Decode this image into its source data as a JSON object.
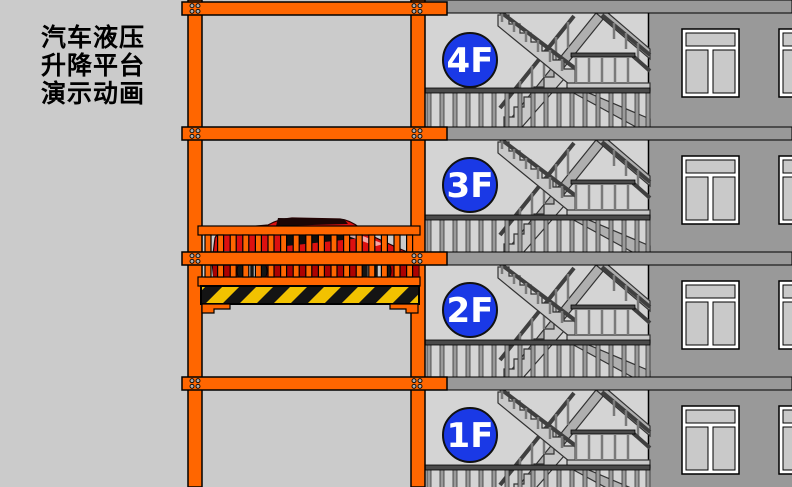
{
  "title": {
    "lines": [
      "汽车液压",
      "升降平台",
      "演示动画"
    ]
  },
  "building": {
    "floors": [
      {
        "label": "4F"
      },
      {
        "label": "3F"
      },
      {
        "label": "2F"
      },
      {
        "label": "1F"
      }
    ]
  },
  "colors": {
    "bg": "#CBCBCB",
    "stairwell": "#D4D4D4",
    "wall": "#999999",
    "orange": "#FF6600",
    "blue": "#1A39E6",
    "car_red": "#DD1010",
    "hazard_yellow": "#F2C200",
    "label_text": "#FFFFFF"
  }
}
